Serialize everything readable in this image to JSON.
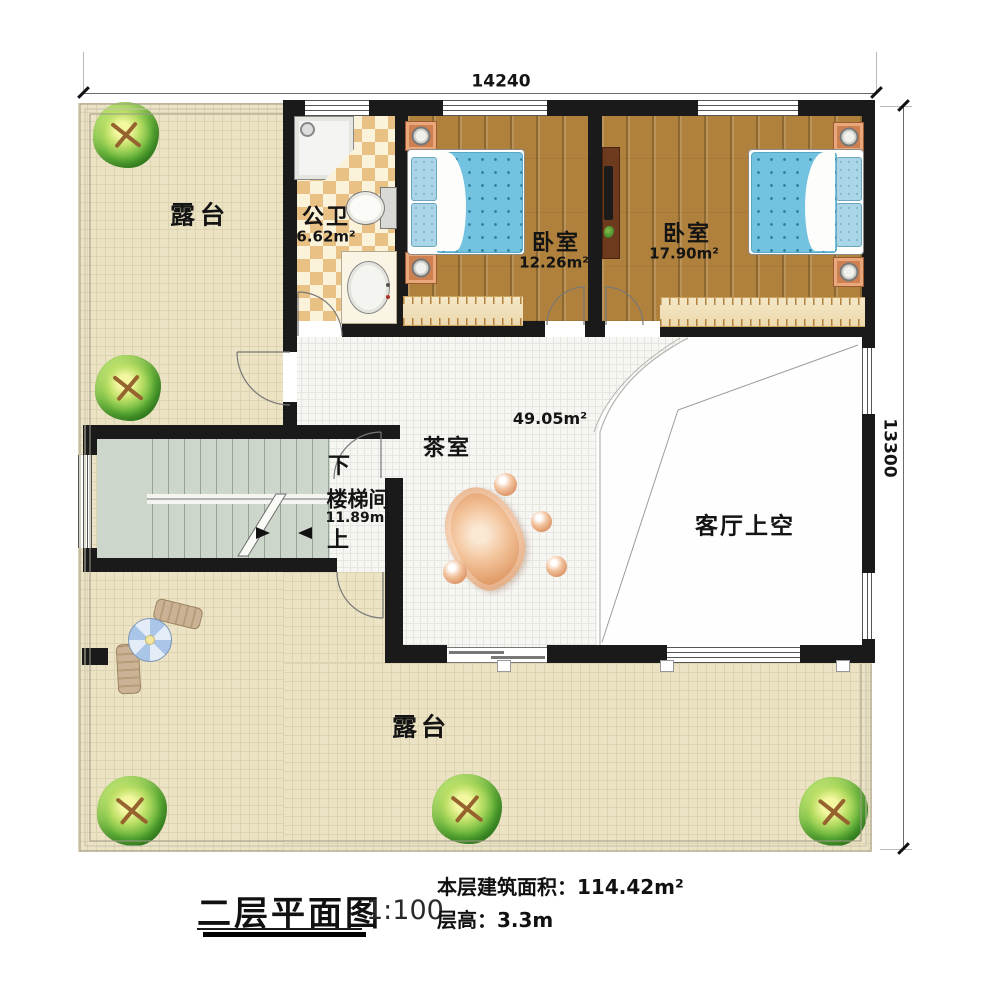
{
  "dimensions": {
    "top_width": "14240",
    "right_height": "13300"
  },
  "rooms": {
    "terrace_top": {
      "name": "露台"
    },
    "terrace_bottom": {
      "name": "露台"
    },
    "bathroom": {
      "name": "公卫",
      "area": "6.62m²"
    },
    "bedroom_small": {
      "name": "卧室",
      "area": "12.26m²"
    },
    "bedroom_large": {
      "name": "卧室",
      "area": "17.90m²"
    },
    "hall": {
      "area": "49.05m²"
    },
    "tea_room": {
      "name": "茶室"
    },
    "stairwell": {
      "name": "楼梯间",
      "area": "11.89m²",
      "down": "下",
      "up": "上"
    },
    "living_room_void": {
      "name": "客厅上空"
    }
  },
  "footer": {
    "title": "二层平面图",
    "scale": "1:100",
    "floor_area": "本层建筑面积：114.42m²",
    "floor_height": "层高：3.3m"
  },
  "colors": {
    "wall": "#1a1a1a",
    "terrace": "#ebe3c4",
    "wood_floor": "#b0813c",
    "bath_checker": "#e9c184",
    "stair_floor": "#cdd6cb",
    "tile": "#f6f6f3",
    "mattress_blue": "#72c2e0",
    "nightstand_orange": "#cf8050",
    "tree_green": "#63b43a"
  }
}
